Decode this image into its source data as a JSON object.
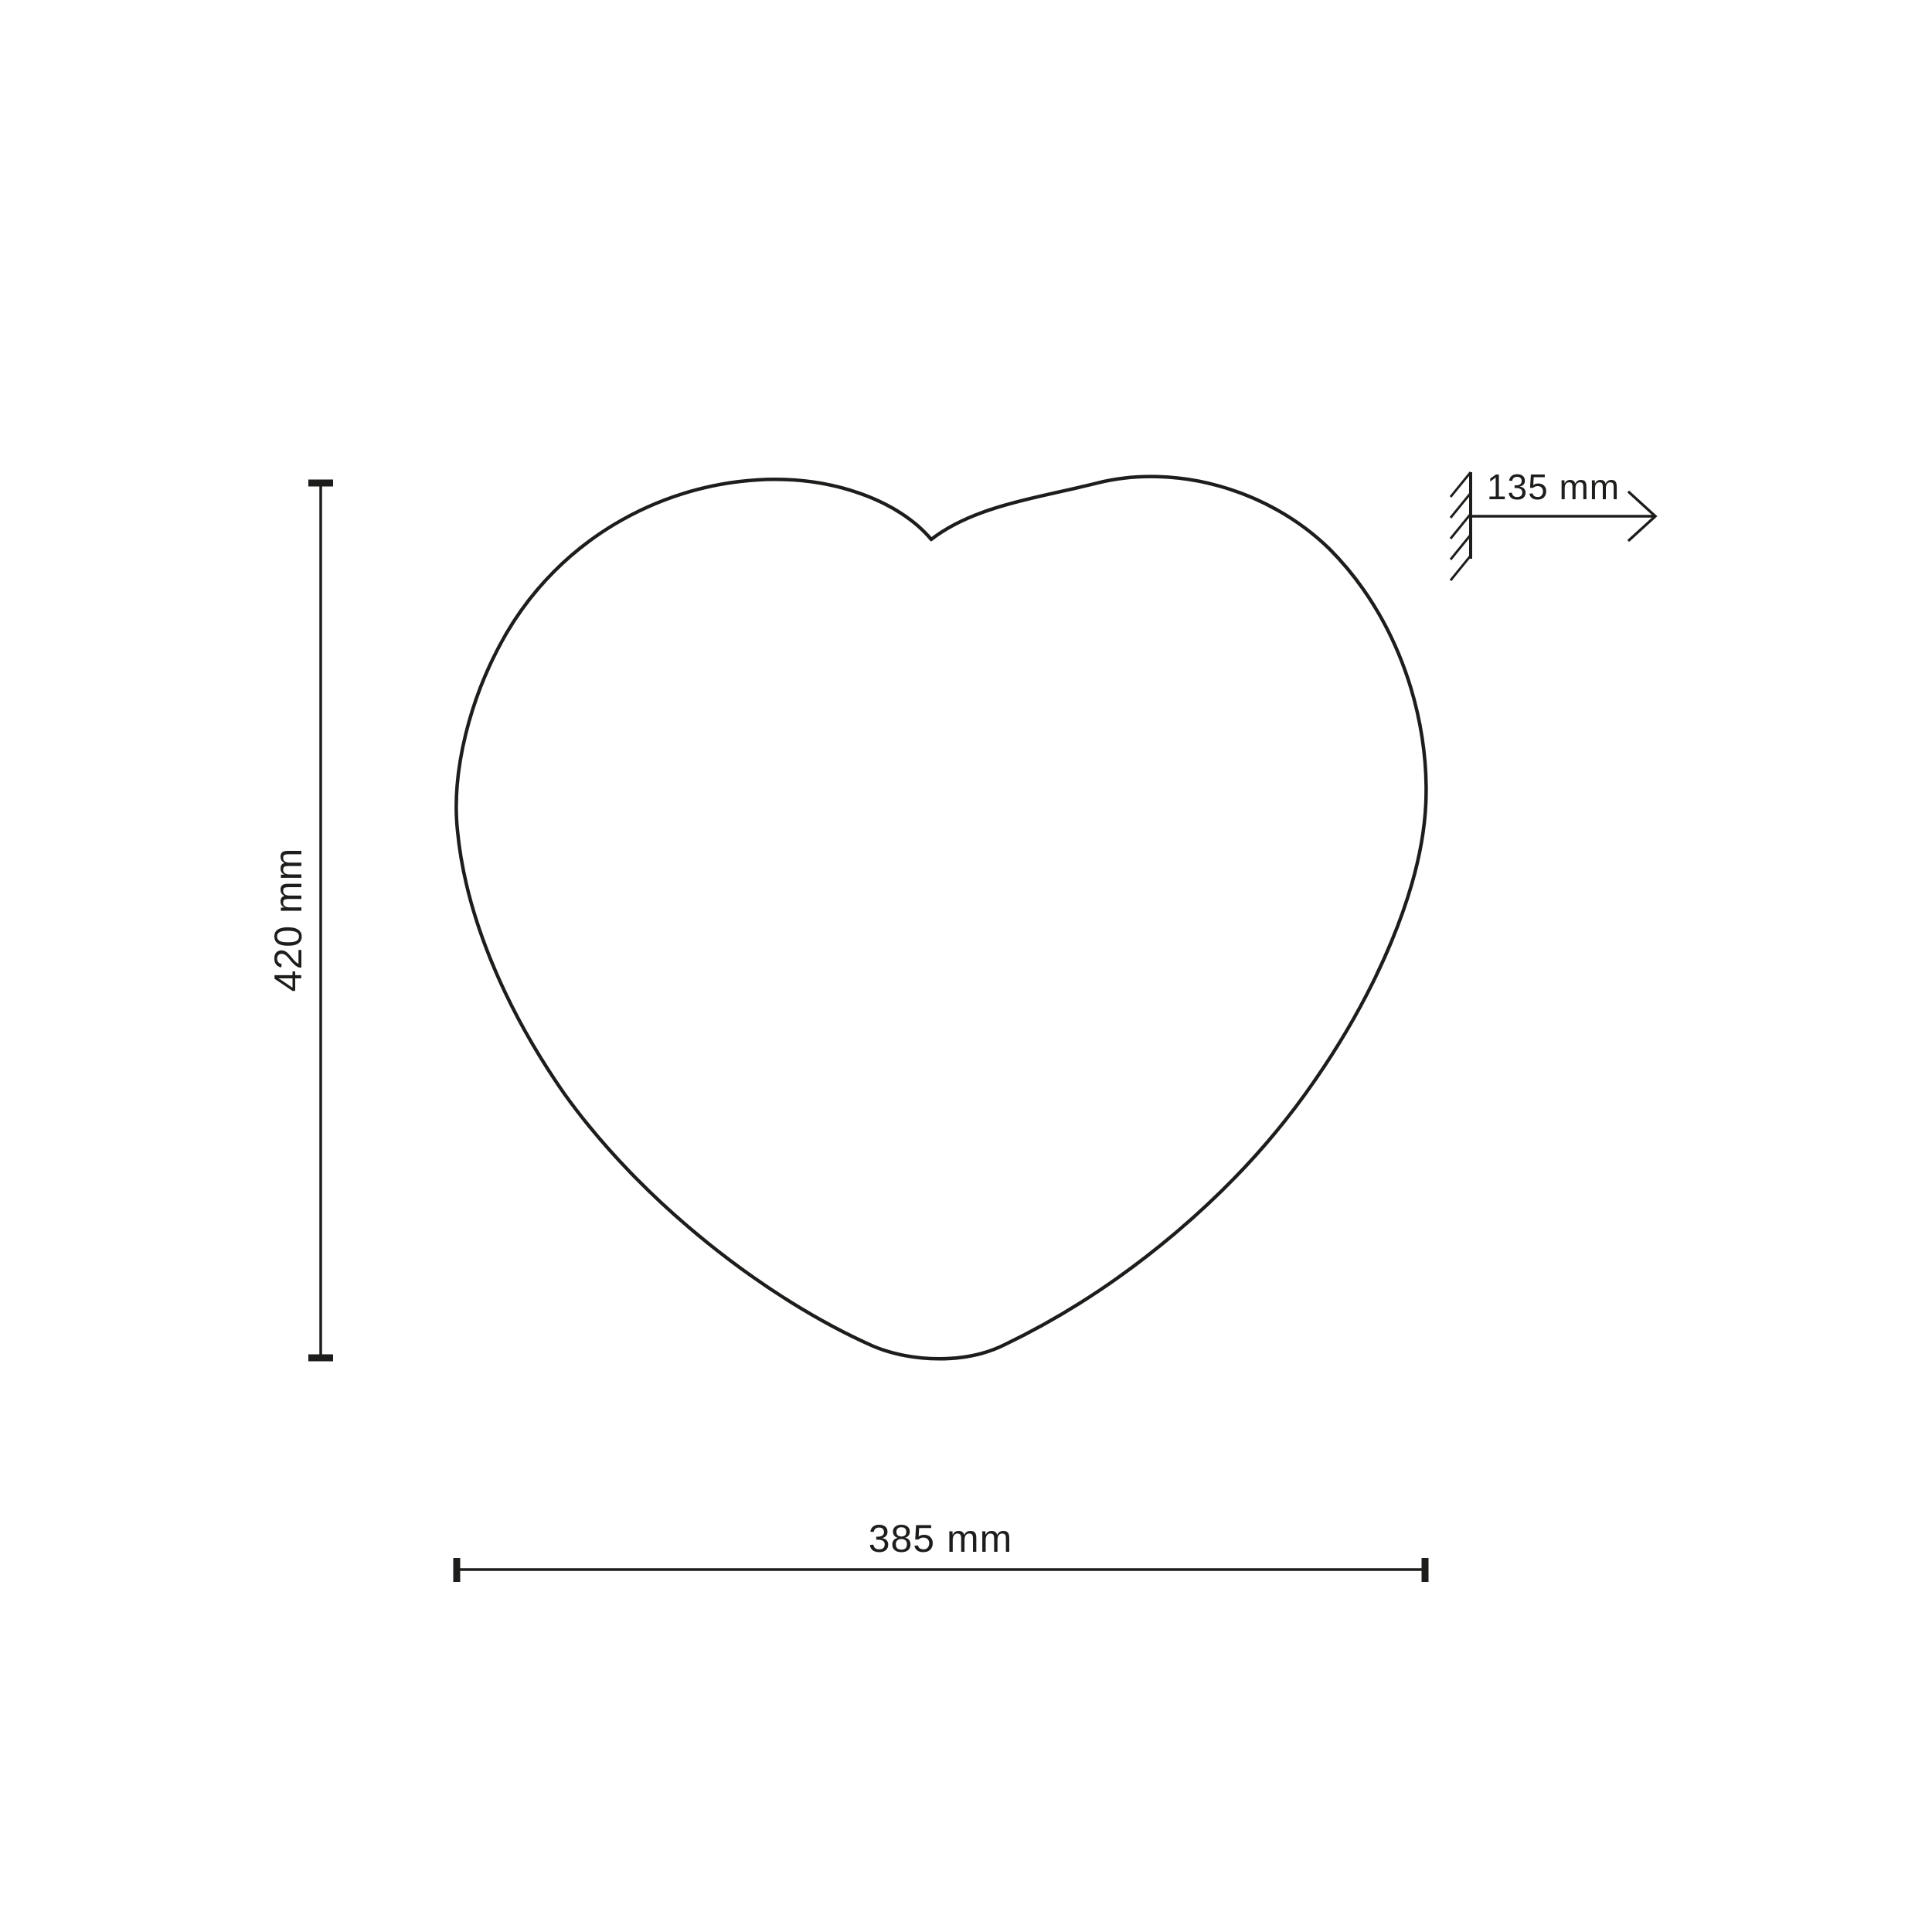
{
  "diagram": {
    "shape": "heart-outline",
    "dimensions": {
      "height": {
        "label": "420 mm"
      },
      "width": {
        "label": "385 mm"
      },
      "depth": {
        "label": "135 mm"
      }
    },
    "colors": {
      "line": "#1d1d1b",
      "background": "#ffffff"
    }
  }
}
